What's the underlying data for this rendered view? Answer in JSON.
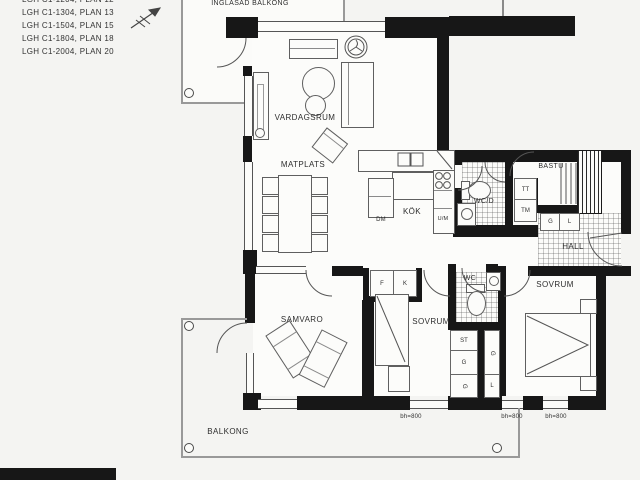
{
  "legend": {
    "lines": [
      "LGH C1-1204, PLAN 12",
      "LGH C1-1304, PLAN 13",
      "LGH C1-1504, PLAN 15",
      "LGH C1-1804, PLAN 18",
      "LGH C1-2004, PLAN 20"
    ]
  },
  "rooms": {
    "inglasad_balkong": "INGLASAD BALKONG",
    "vardagsrum": "VARDAGSRUM",
    "matplats": "MATPLATS",
    "kok": "KÖK",
    "wcd": "WC/D",
    "bastu": "BASTU",
    "hall": "HALL",
    "sovrum_master": "SOVRUM",
    "sovrum_2": "SOVRUM",
    "wc": "WC",
    "samvaro": "SAMVARO",
    "balkong": "BALKONG"
  },
  "fixtures": {
    "dm": "DM",
    "um": "U/M",
    "f": "F",
    "k": "K",
    "tt": "TT",
    "tm": "TM",
    "hall_g": "G",
    "hall_l": "L",
    "st": "ST",
    "g_mid": "G",
    "g_low": "G",
    "g_tall": "G",
    "l_low": "L"
  },
  "dimensions": {
    "bh_1": "bh=800",
    "bh_2": "bh=800",
    "bh_3": "bh=800"
  },
  "colors": {
    "wall": "#171717",
    "line": "#5f5f5f",
    "text": "#2e2e2e"
  }
}
